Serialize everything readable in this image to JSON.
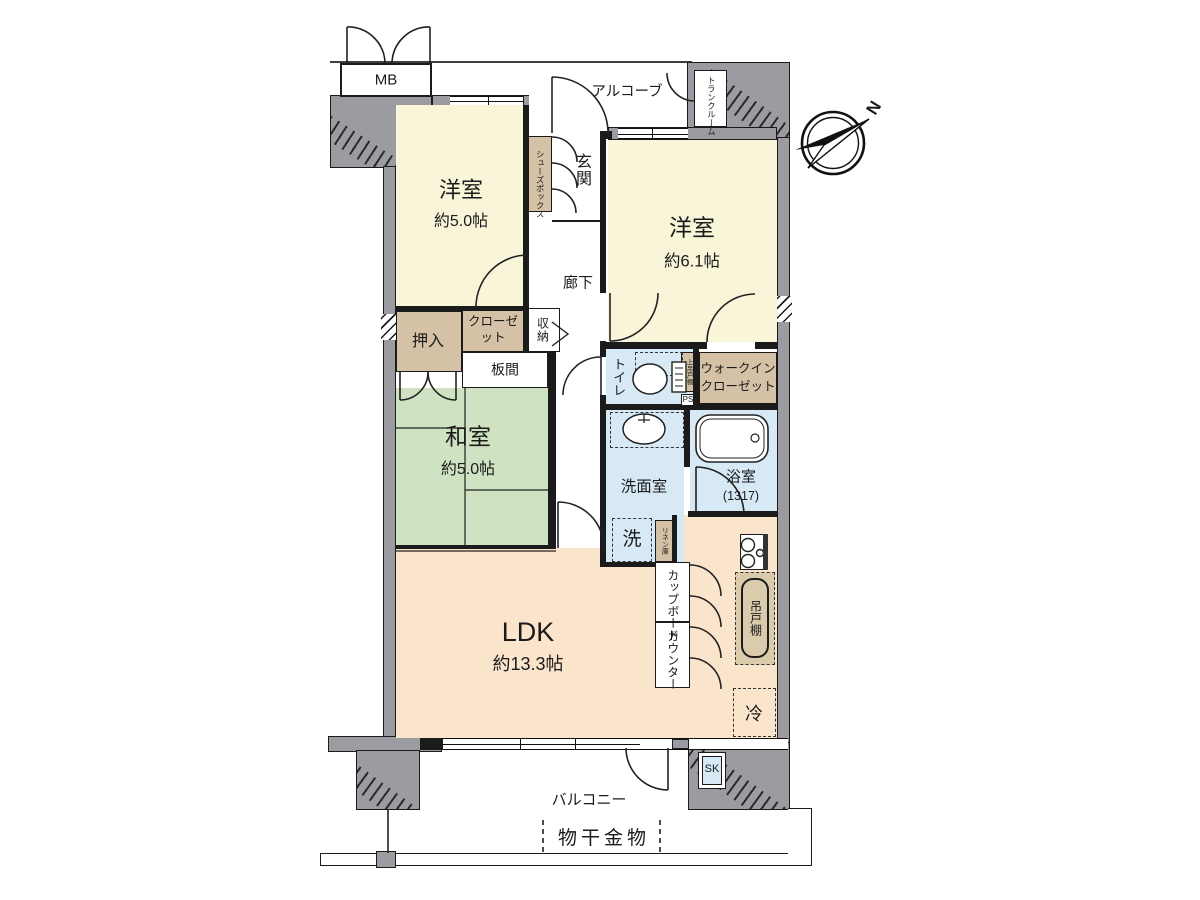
{
  "title": "マンション間取り図",
  "rooms": {
    "western1": {
      "name": "洋室",
      "size": "約5.0帖"
    },
    "western2": {
      "name": "洋室",
      "size": "約6.1帖"
    },
    "japanese": {
      "name": "和室",
      "size": "約5.0帖"
    },
    "ldk": {
      "name": "LDK",
      "size": "約13.3帖"
    },
    "bathroom": {
      "name": "浴室",
      "size": "(1317)"
    }
  },
  "labels": {
    "alcove": "アルコーブ",
    "meter_box": "MB",
    "trunk_room": "トランクルーム",
    "entrance": "玄関",
    "shoe_box": "シューズボックス",
    "corridor": "廊下",
    "oshiire": "押入",
    "closet": "クローゼット",
    "storage": "収納",
    "itama": "板間",
    "toilet": "トイレ",
    "toilet_upper_cabinet": "上吊戸棚",
    "pipe_space": "PS",
    "walk_in_closet": "ウォークインクローゼット",
    "washroom": "洗面室",
    "washer": "洗",
    "linen": "リネン庫",
    "cupboard": "カップボード",
    "counter": "カウンター",
    "hanging_cabinet": "吊戸棚",
    "fridge": "冷",
    "slop_sink": "SK",
    "balcony": "バルコニー",
    "drying_fixture": "物干金物",
    "compass_north": "N"
  },
  "colors": {
    "wall_gray": "#9b9ba1",
    "room_yellow": "#f8f5d9",
    "tatami_green": "#cfe3c2",
    "water_blue": "#d6e9f5",
    "storage_tan": "#d5c1a5",
    "ldk_peach": "#fbe4cc",
    "kitchen_tan": "#dacbad",
    "line_black": "#1b1b1b"
  }
}
